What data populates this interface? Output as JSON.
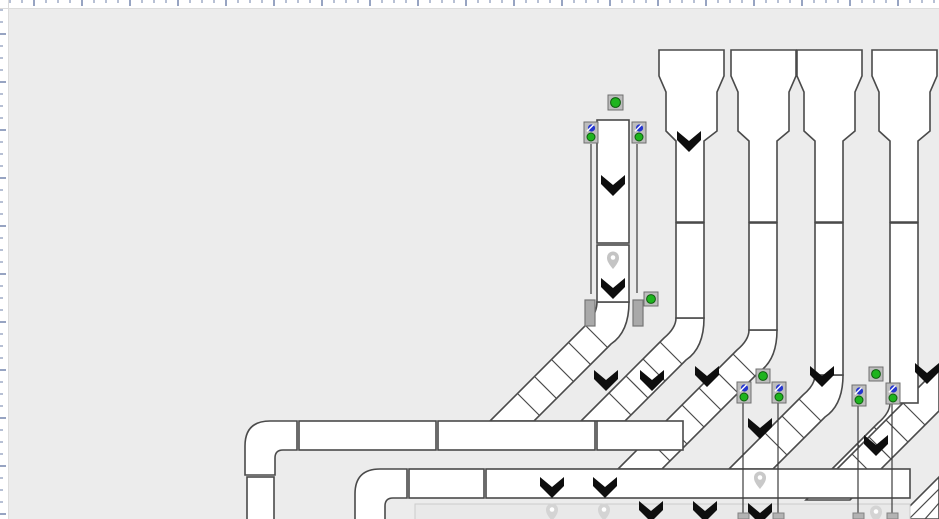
{
  "app": {
    "name": "conveyor-layout-editor",
    "description": "2D layout canvas of a baggage/parcel conveyor system: four hopper-fed vertical lanes and one stand-alone vertical line merging via 45-degree slatted belts onto horizontal collector conveyors; photo-eye sensors and tracking pins shown"
  },
  "colors": {
    "canvas_bg": "#ececec",
    "piece_fill": "#ffffff",
    "piece_stroke": "#4a4a4a",
    "chevron": "#0e0e0e",
    "sensor_box": "#bdbdbd",
    "sensor_box_stroke": "#6f6f6f",
    "green": "#1eb41e",
    "green_ring": "#0e5c0e",
    "blue": "#2334cf",
    "guard": "#a9a9a9",
    "guard_stroke": "#757575",
    "beam": "#3c3c3c",
    "belt_low_fill": "#e9e9e9",
    "belt_low_stroke": "#cccccc",
    "foot": "#b3b3b3",
    "foot_stroke": "#828282",
    "pin_hole": "#ffffff"
  },
  "rulers": {
    "size": 8,
    "bg": "#ffffff",
    "edge": "#dcdcdc",
    "tick_start": 10,
    "tick_step": 12,
    "tall_every": 4,
    "tall_offset": 2,
    "tick_len": 3,
    "tall_len": 6,
    "tick_color": "#b7c0d4",
    "tall_color": "#97a4c2"
  },
  "diagram": {
    "pieces": [
      {
        "name": "merge-belt-m",
        "d": "M 597,302 H 629 Q 629,332 611,344 L 534,421 H 490 L 589,322 Q 597,312 597,302 Z"
      },
      {
        "name": "merge-belt-m-slats",
        "deco": true,
        "d": "M608,348L586,326M591,365L569,343M574,382L552,360M557,399L535,377M540,416L518,394"
      },
      {
        "name": "merge-belt-1",
        "d": "M 676,318 H 704 Q 704,348 686,360 L 625,421 H 581 L 664,338 Q 676,328 676,318 Z"
      },
      {
        "name": "merge-belt-1-slats",
        "deco": true,
        "d": "M682,364L660,342M665,381L643,359M648,398L626,376M631,415L609,393"
      },
      {
        "name": "merge-belt-2",
        "d": "M 749,330 H 777 Q 777,360 759,372 L 662,469 H 618 L 737,350 Q 749,340 749,330 Z"
      },
      {
        "name": "merge-belt-2-slats",
        "deco": true,
        "d": "M755,376L733,354M738,393L716,371M721,410L699,388M704,427L682,405M687,444L665,422M670,461L648,439"
      },
      {
        "name": "merge-belt-3",
        "d": "M 815,375 H 843 Q 843,405 825,417 L 773,469 H 729 L 803,395 Q 815,385 815,375 Z"
      },
      {
        "name": "merge-belt-3-slats",
        "deco": true,
        "d": "M821,421L799,399M804,438L782,416M787,455L765,433"
      },
      {
        "name": "merge-belt-4",
        "d": "M 890,403 H 918 Q 918,433 900,445 L 876,469 H 832 L 878,423 Q 890,413 890,403 Z"
      },
      {
        "name": "merge-belt-4-slats",
        "deco": true,
        "d": "M896,449L874,427M879,466L857,444"
      },
      {
        "name": "merge-belt-edge",
        "d": "M 939,411 L 850,500 H 806 L 939,367 Z"
      },
      {
        "name": "merge-belt-edge-slats",
        "deco": true,
        "d": "M925,425L903,403M908,442L886,420M891,459L869,437M874,476L852,454M857,493L835,471"
      },
      {
        "name": "merge-belt-corner",
        "d": "M 939,477 V 519 H 897 Z"
      },
      {
        "name": "merge-belt-corner-slats",
        "deco": true,
        "d": "M909,519L939,489M925,519L939,503"
      },
      {
        "name": "hopper-1",
        "d": "M 659,50 H 724 V 76 L 717,92 V 131 L 704,141 V 222 H 676 V 141 L 666,131 V 92 L 659,76 Z"
      },
      {
        "name": "hopper-2",
        "d": "M 731,50 H 796 V 76 L 789,92 V 131 L 777,141 V 222 H 749 V 141 L 738,131 V 92 L 731,76 Z"
      },
      {
        "name": "hopper-3",
        "d": "M 797,50 H 862 V 76 L 855,92 V 131 L 843,141 V 222 H 815 V 141 L 804,131 V 92 L 797,76 Z"
      },
      {
        "name": "hopper-4",
        "d": "M 872,50 H 937 V 76 L 930,92 V 131 L 918,141 V 222 H 890 V 141 L 879,131 V 92 L 872,76 Z"
      },
      {
        "name": "lane-1-segment",
        "rect": [
          676,
          223,
          28,
          95
        ]
      },
      {
        "name": "lane-2-segment",
        "rect": [
          749,
          223,
          28,
          107
        ]
      },
      {
        "name": "lane-3-segment",
        "rect": [
          815,
          223,
          28,
          152
        ]
      },
      {
        "name": "lane-4-segment",
        "rect": [
          890,
          223,
          28,
          180
        ]
      },
      {
        "name": "line-m-segment-1",
        "rect": [
          597,
          120,
          32,
          123
        ]
      },
      {
        "name": "line-m-segment-2",
        "rect": [
          597,
          245,
          32,
          57
        ]
      },
      {
        "name": "collector-1-elbow",
        "d": "M 245,475 V 446 Q 245,421 270,421 H 297 V 450 H 283 Q 275,450 275,458 V 475 Z"
      },
      {
        "name": "collector-1-feed",
        "rect": [
          247,
          477,
          27,
          45
        ]
      },
      {
        "name": "collector-1-segment-1",
        "rect": [
          299,
          421,
          137,
          29
        ]
      },
      {
        "name": "collector-1-segment-2",
        "rect": [
          438,
          421,
          157,
          29
        ]
      },
      {
        "name": "collector-1-segment-3",
        "rect": [
          597,
          421,
          86,
          29
        ]
      },
      {
        "name": "collector-2-elbow",
        "d": "M 355,524 V 494 Q 355,469 380,469 H 407 V 498 H 393 Q 385,498 385,506 V 524 Z"
      },
      {
        "name": "collector-2-segment-1",
        "rect": [
          409,
          469,
          75,
          29
        ]
      },
      {
        "name": "collector-2-segment-2",
        "rect": [
          486,
          469,
          424,
          29
        ]
      },
      {
        "name": "collector-3-lowline",
        "rect": [
          415,
          504,
          495,
          17
        ],
        "fill": "#e9e9e9",
        "stroke": "#cccccc",
        "sw": 1
      }
    ],
    "guards": [
      {
        "name": "side-guard-left",
        "rect": [
          585,
          300,
          10,
          26
        ]
      },
      {
        "name": "side-guard-right",
        "rect": [
          633,
          300,
          10,
          26
        ]
      }
    ],
    "beams": [
      {
        "x": 591,
        "y1": 144,
        "y2": 294
      },
      {
        "x": 637,
        "y1": 144,
        "y2": 293
      },
      {
        "x": 743,
        "y1": 402,
        "y2": 513
      },
      {
        "x": 778,
        "y1": 402,
        "y2": 513
      },
      {
        "x": 858,
        "y1": 405,
        "y2": 513
      },
      {
        "x": 892,
        "y1": 403,
        "y2": 513
      }
    ],
    "feet": [
      [
        738,
        513
      ],
      [
        773,
        513
      ],
      [
        853,
        513
      ],
      [
        887,
        513
      ]
    ],
    "photo_eyes": [
      [
        584,
        122
      ],
      [
        632,
        122
      ],
      [
        737,
        382
      ],
      [
        772,
        382
      ],
      [
        852,
        385
      ],
      [
        886,
        383
      ]
    ],
    "green_sensors": [
      [
        608,
        95,
        15
      ],
      [
        644,
        292,
        14
      ],
      [
        756,
        369,
        14
      ],
      [
        869,
        367,
        14
      ]
    ],
    "chevrons": [
      [
        689,
        142
      ],
      [
        613,
        186
      ],
      [
        613,
        289
      ],
      [
        606,
        381
      ],
      [
        652,
        381
      ],
      [
        707,
        377
      ],
      [
        822,
        377
      ],
      [
        927,
        374
      ],
      [
        760,
        429
      ],
      [
        876,
        446
      ],
      [
        552,
        488
      ],
      [
        605,
        488
      ],
      [
        651,
        512
      ],
      [
        705,
        512
      ],
      [
        760,
        514
      ]
    ],
    "pins": [
      {
        "x": 613,
        "y": 261,
        "shade": "#c4c4c4"
      },
      {
        "x": 760,
        "y": 481,
        "shade": "#c9c9c9"
      },
      {
        "x": 552,
        "y": 513,
        "shade": "#d4d4d4"
      },
      {
        "x": 604,
        "y": 513,
        "shade": "#d4d4d4"
      },
      {
        "x": 876,
        "y": 515,
        "shade": "#d4d4d4"
      }
    ]
  }
}
